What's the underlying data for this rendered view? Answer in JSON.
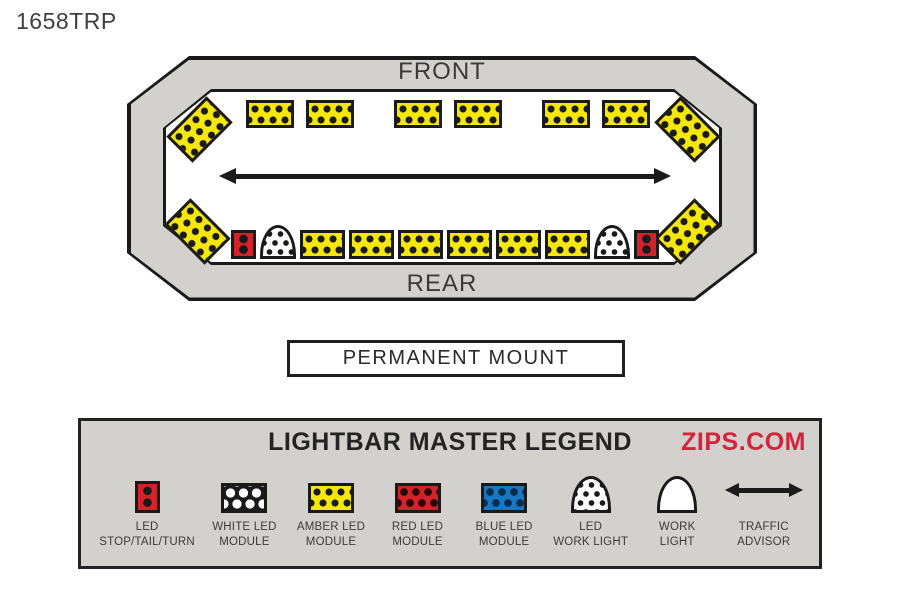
{
  "page": {
    "part_number": "1658TRP"
  },
  "lightbar": {
    "front_label": "FRONT",
    "rear_label": "REAR",
    "mount_label": "PERMANENT MOUNT",
    "center_element": "traffic-advisor",
    "front_row": [
      "amber-led-module",
      "amber-led-module",
      "amber-led-module",
      "amber-led-module",
      "amber-led-module",
      "amber-led-module"
    ],
    "rear_row": [
      "led-stop-tail-turn",
      "led-work-light",
      "amber-led-module",
      "amber-led-module",
      "amber-led-module",
      "amber-led-module",
      "amber-led-module",
      "amber-led-module",
      "led-work-light",
      "led-stop-tail-turn"
    ],
    "corner_modules": [
      "amber-led-module",
      "amber-led-module",
      "amber-led-module",
      "amber-led-module"
    ]
  },
  "legend": {
    "title": "LIGHTBAR MASTER LEGEND",
    "brand": "ZIPS.COM",
    "items": [
      {
        "icon": "led-stop-tail-turn",
        "label_line1": "LED",
        "label_line2": "STOP/TAIL/TURN"
      },
      {
        "icon": "white-led-module",
        "label_line1": "WHITE LED",
        "label_line2": "MODULE"
      },
      {
        "icon": "amber-led-module",
        "label_line1": "AMBER LED",
        "label_line2": "MODULE"
      },
      {
        "icon": "red-led-module",
        "label_line1": "RED LED",
        "label_line2": "MODULE"
      },
      {
        "icon": "blue-led-module",
        "label_line1": "BLUE LED",
        "label_line2": "MODULE"
      },
      {
        "icon": "led-work-light",
        "label_line1": "LED",
        "label_line2": "WORK LIGHT"
      },
      {
        "icon": "work-light",
        "label_line1": "WORK",
        "label_line2": "LIGHT"
      },
      {
        "icon": "traffic-advisor",
        "label_line1": "TRAFFIC",
        "label_line2": "ADVISOR"
      }
    ]
  },
  "colors": {
    "amber": "#f6e70a",
    "red": "#d3222a",
    "blue": "#1878bf",
    "white": "#ffffff",
    "black": "#1a1a1a",
    "housing_gray": "#d3d1ce",
    "legend_bg": "#d3d1ce",
    "brand_red": "#d3243c",
    "text_dark": "#3b3b3b"
  }
}
